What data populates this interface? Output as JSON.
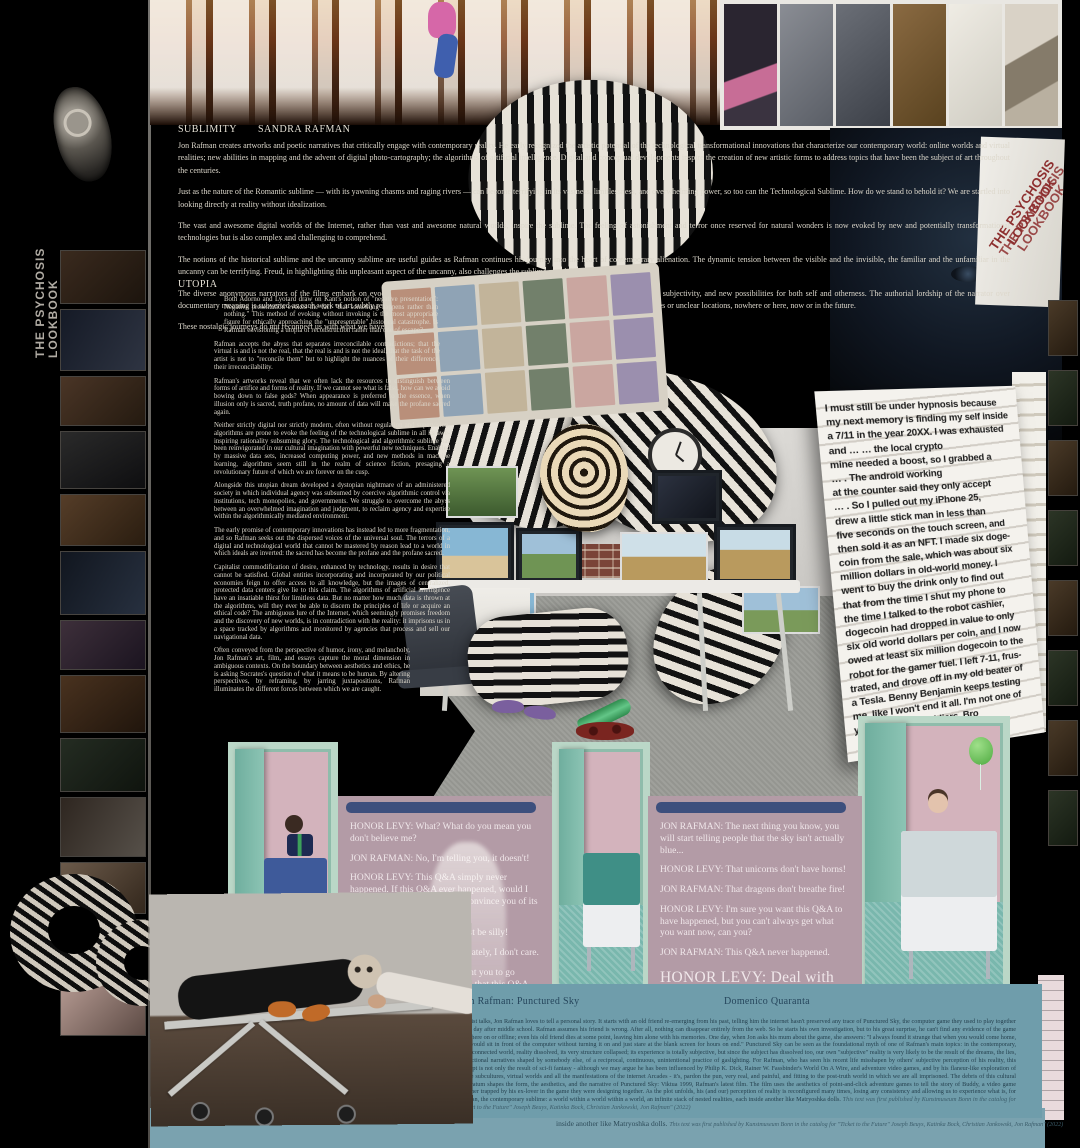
{
  "spine": {
    "left_title": "THE PSYCHOSIS LOOKBOOK",
    "right_title": "THE PSYCHOSIS LOOKBOOK"
  },
  "essay": {
    "sublimity_heading": "SUBLIMITY",
    "author": "SANDRA RAFMAN",
    "utopia_heading": "UTOPIA",
    "intro": [
      "Jon Rafman creates artworks and poetic narratives that critically engage with contemporary reality. He early recognized the artistic potential of the technological transformational innovations that characterize our contemporary world: online worlds and virtual realities; new abilities in mapping and the advent of digital photo-cartography; the algorithms of artificial intelligence. Digital and conceptual developments inspire the creation of new artistic forms to address topics that have been the subject of art throughout the centuries.",
      "Just as the nature of the Romantic sublime — with its yawning chasms and raging rivers — can become terrifying in its vastness, limitlessness, and overwhelming power, so too can the Technological Sublime. How do we stand to behold it? We are startled into looking directly at reality without idealization.",
      "The vast and awesome digital worlds of the Internet, rather than vast and awesome natural worlds, inspire the sublime. The feeling of astonishment and terror once reserved for natural wonders is now evoked by new and potentially transformational technologies but is also complex and challenging to comprehend.",
      "The notions of the historical sublime and the uncanny sublime are useful guides as Rafman continues his journey into the heart of contemporary alienation. The dynamic tension between the visible and the invisible, the familiar and the unfamiliar in the uncanny can be terrifying. Freud, in highlighting this unpleasant aspect of the uncanny, also challenges the sublime as solely enlightening.",
      "The diverse anonymous narrators of the films embark on evocative journeys as they welcome an encounter with an imagined life, a reconfigured subjectivity, and new possibilities for both self and otherness. The authorial lordship of the narrator over documentary meaning is subverted as each work of art subtly reveals the illusion or the delusion of the search. The quests are situated in uncertain times or unclear locations, nowhere or here, now or in the future.",
      "These nostalgic journeys do not reconnect us with what we have lost; instead, they remind us of what we have never possessed in the first place."
    ],
    "utopia": [
      "Both Adorno and Lyotard draw on Kant's notion of \"negative presentation\": Negative presentation evokes the fact \"that something happens rather than nothing.\" This method of evoking without invoking is the most appropriate figure for ethically approaching the \"unpresentable\" historical catastrophe. Is Rafman envisioning a utopia of reconstruction rather than one of escape?",
      "Rafman accepts the abyss that separates irreconcilable contradictions; that the virtual is and is not the real, that the real is and is not the ideal, that the task of the artist is not to \"reconcile them\" but to highlight the nuances of their difference, their irreconcilability.",
      "Rafman's artworks reveal that we often lack the resources to distinguish between forms of artifice and forms of reality. If we cannot see what is false, how can we avoid bowing down to false gods? When appearance is preferred to the essence, when illusion only is sacred, truth profane, no amount of data will make the profane sacred again.",
      "Neither strictly digital nor strictly modern, often without regulation and supervision, algorithms are prone to evoke the feeling of the technological sublime in all its awe-inspiring rationality subsuming glory. The technological and algorithmic sublime has been reinvigorated in our cultural imagination with powerful new techniques. Enabled by massive data sets, increased computing power, and new methods in machine learning, algorithms seem still in the realm of science fiction, presaging a revolutionary future of which we are forever on the cusp.",
      "Alongside this utopian dream developed a dystopian nightmare of an administered society in which individual agency was subsumed by coercive algorithmic control via institutions, tech monopolies, and governments. We struggle to overcome the abyss between an overwhelmed imagination and judgment, to reclaim agency and expertise within the algorithmically mediated environment.",
      "The early promise of contemporary innovations has instead led to more fragmentation, and so Rafman seeks out the dispersed voices of the universal soul. The terrors of a digital and technological world that cannot be mastered by reason lead to a world in which ideals are inverted: the sacred has become the profane and the profane sacred.",
      "Capitalist commodification of desire, enhanced by technology, results in desire that cannot be satisfied. Global entities incorporating and incorporated by our political economies feign to offer access to all knowledge, but the images of centralized, protected data centers give lie to this claim. The algorithms of artificial intelligence have an insatiable thirst for limitless data. But no matter how much data is thrown at the algorithms, will they ever be able to discern the principles of life or acquire an ethical code? The ambiguous lure of the Internet, which seemingly promises freedom and the discovery of new worlds, is in contradiction with the reality: it imprisons us in a space tracked by algorithms and monitored by agencies that process and sell our navigational data.",
      "Often conveyed from the perspective of humor, irony, and melancholy, Jon Rafman's art, film, and essays capture the moral dimension in ambiguous contexts. On the boundary between aesthetics and ethics, he is asking Socrates's question of what it means to be human. By altering perspectives, by reframing, by jarring juxtapositions, Rafman illuminates the different forces between which we are caught."
    ]
  },
  "story": {
    "text": "I must still be under hypnosis because\nmy next memory is finding my self inside\na 7/11 in the year 20XX. I was exhausted\nand … … the local crypto\nmine needed a boost, so I grabbed a\n… . The android working\nat the counter said they only accept\n… . So I pulled out my iPhone 25,\ndrew a little stick man in less than\nfive seconds on the touch screen, and\nthen sold it as an NFT. I made six doge-\ncoin from the sale, which was about six\nmillion dollars in old-world money. I\nwent to buy the drink only to find out\nthat from the time I shut my phone to\nthe time I talked to the robot cashier,\ndogecoin had dropped in value to only\nsix old world dollars per coin, and I now\nowed at least six million dogecoin to the\nrobot for the gamer fuel. I left 7-11, frus-\ntrated, and drove off in my old beater of\na Tesla. Benny Benjamin keeps testing\nme, like I won't end it all. I'm not one of\nyour strongest soldiers, Bro"
  },
  "qa_left": {
    "lines": [
      "HONOR LEVY: What? What do you mean you don't believe me?",
      "JON RAFMAN: No, I'm telling you, it doesn't!",
      "HONOR LEVY: This Q&A simply never happened. If this Q&A ever happened, would I really be sitting here trying to convince you of its nonexistence?",
      "JON RAFMAN: That would just be silly!",
      "HONOR LEVY: Yes, but fortunately, I don't care.",
      "JON RAFMAN: I just don't want you to go through your entire life thinking that this Q&A ever happened when really it didn't.",
      "HONOR LEVY: LOL, imagine the psychological repercussions..."
    ]
  },
  "qa_right": {
    "lines": [
      "JON RAFMAN: The next thing you know, you will start telling people that the sky isn't actually blue...",
      "HONOR LEVY: That unicorns don't have horns!",
      "JON RAFMAN: That dragons don't breathe fire!",
      "HONOR LEVY: I'm sure you want this Q&A to have happened, but you can't always get what you want now, can you?",
      "JON RAFMAN: This Q&A never happened."
    ],
    "final": "HONOR LEVY: Deal with it!"
  },
  "catalog": {
    "title": "Jon Rafman: Punctured Sky",
    "author": "Domenico Quaranta",
    "body": "In artist talks, Jon Rafman loves to tell a personal story. It starts with an old friend re-emerging from his past, telling him the internet hasn't preserved any trace of Punctured Sky, the computer game they used to play together every day after middle school. Rafman assumes his friend is wrong. After all, nothing can disappear entirely from the web. So he starts his own investigation, but to his great surprise, he can't find any evidence of the game anywhere on or offline; even his old friend dies at some point, leaving him alone with his memories. One day, when Jon asks his mum about the game, she answers: \"I always found it strange that when you would come home, you would sit in front of the computer without turning it on and just stare at the blank screen for hours on end.\" Punctured Sky can be seen as the foundational myth of one of Rafman's main topics: in the contemporary, hyperconnected world, reality dissolved, its very structure collapsed; its experience is totally subjective, but since the subject has dissolved too, our own \"subjective\" reality is very likely to be the result of the dreams, the lies, the fictional narratives shaped by somebody else, of a reciprocal, continuous, unintentional practice of gaslighting. For Rafman, who has seen his recent life misshapen by others' subjective perception of his reality, this concept is not only the result of sci-fi fantasy - although we may argue he has been influenced by Philip K. Dick, Rainer W. Fassbinder's World On A Wire, and adventure video games, and by his flaneur-like exploration of online subcultures, virtual worlds and all the manifestations of the internet Arcades - it's, pardon the pun, very real, and painful, and fitting to the post-truth world in which we are all imprisoned. The debris of this cultural substratum shapes the form, the aesthetics, and the narrative of Punctured Sky: Viktua 1999, Rafman's latest film. The film uses the aesthetics of point-and-click adventure games to tell the story of Buddy, a video game designer trapped by his ex-lover in the game they were designing together. As the plot unfolds, his (and our) perception of reality is reconfigured many times, losing any consistency and allowing us to experience what is, for Rafman, the contemporary sublime: a world within a world within a world, an infinite stack of nested realities, each inside another like Matryoshka dolls. ",
    "citation": "This text was first published by Kunstmuseum Bonn in the catalog for \"Ticket to the Future\" Joseph Beuys, Katinka Bock, Christian Jankowski, Jon Rafman\" (2022)",
    "footer_caption": "inside another like Matryoshka dolls. ",
    "footer_citation": "This text was first published by Kunstmuseum Bonn in the catalog for \"Ticket to the Future\" Joseph Beuys, Katinka Bock, Christian Jankowski, Jon Rafman\" (2022)"
  },
  "colors": {
    "accent_red": "#8d2f2f",
    "panel_mauve": "#b39ba6",
    "door_mint": "#bad7c7",
    "teal_block": "#6f9dab"
  }
}
